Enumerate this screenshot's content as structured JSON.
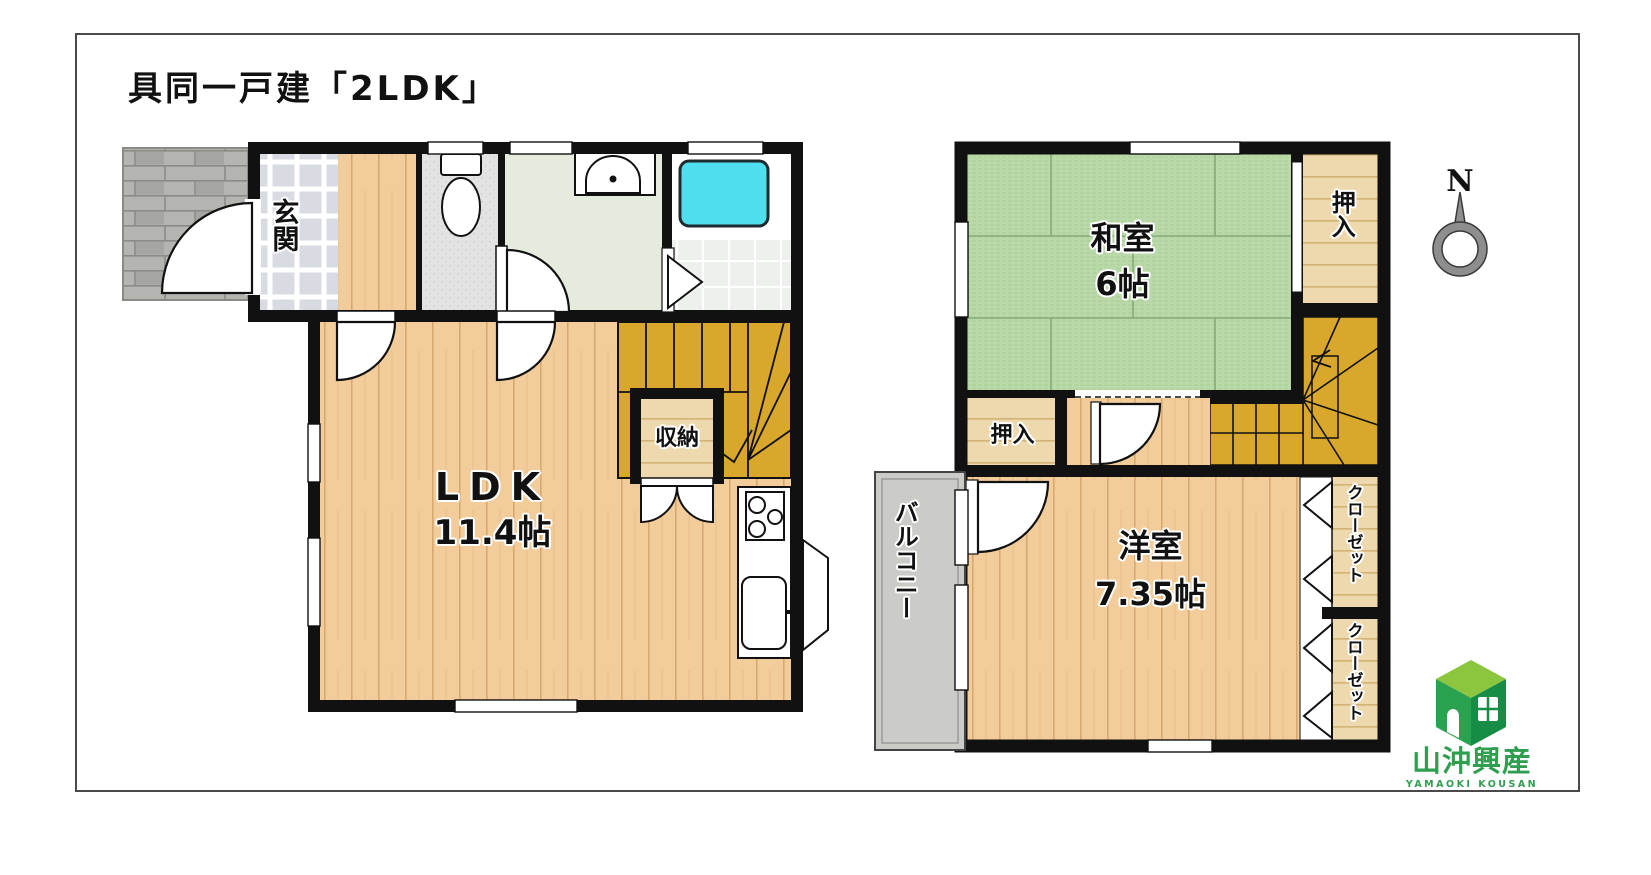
{
  "title": "具同一戸建「2LDK」",
  "floor1": {
    "genkan_label": "玄関",
    "ldk_label": "LDK",
    "ldk_size": "11.4帖",
    "storage_label": "収納"
  },
  "floor2": {
    "washitsu_label": "和室",
    "washitsu_size": "6帖",
    "oshiire_top_label": "押入",
    "oshiire_bottom_label": "押入",
    "balcony_label": "バルコニー",
    "youshitsu_label": "洋室",
    "youshitsu_size": "7.35帖",
    "closet_top_label": "クローゼット",
    "closet_bottom_label": "クローゼット"
  },
  "compass": {
    "north_label": "N"
  },
  "logo": {
    "company_name": "山沖興産",
    "company_romaji": "YAMAOKI KOUSAN"
  },
  "colors": {
    "tatami_green": "#b9d9a9",
    "wood_floor": "#f2cd9b",
    "stairs_gold": "#d9a72c",
    "bathtub_cyan": "#4fdeed",
    "logo_green": "#2f9e4f",
    "wall_black": "#111111"
  }
}
